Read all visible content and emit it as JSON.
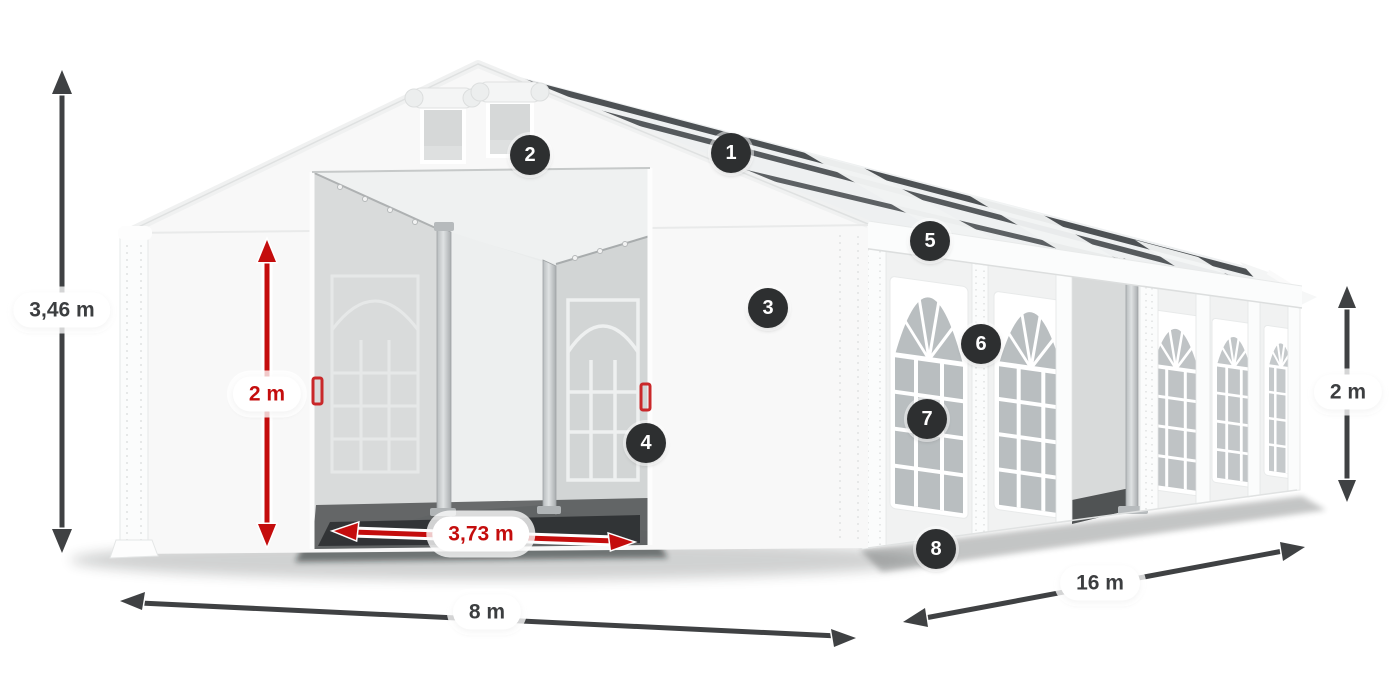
{
  "colors": {
    "accent_red": "#c40d0d",
    "arrow_dark": "#3f4143",
    "badge_background": "#2d2f30",
    "tent_white": "#f8f8f8"
  },
  "badges": [
    {
      "label": "1"
    },
    {
      "label": "2"
    },
    {
      "label": "3"
    },
    {
      "label": "4"
    },
    {
      "label": "5"
    },
    {
      "label": "6"
    },
    {
      "label": "7"
    },
    {
      "label": "8"
    }
  ],
  "dimensions": {
    "total_height": {
      "label": "3,46 m",
      "color": "dark"
    },
    "entrance_height": {
      "label": "2 m",
      "color": "red"
    },
    "entrance_width": {
      "label": "3,73 m",
      "color": "red"
    },
    "width": {
      "label": "8 m",
      "color": "dark"
    },
    "length": {
      "label": "16 m",
      "color": "dark"
    },
    "side_height": {
      "label": "2 m",
      "color": "dark"
    }
  }
}
